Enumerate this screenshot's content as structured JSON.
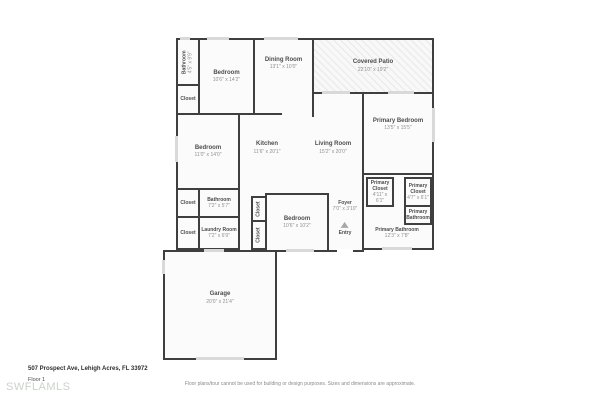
{
  "plan": {
    "address": "507 Prospect Ave, Lehigh Acres, FL 33972",
    "floor_label": "Floor 1",
    "watermark": "SWFLAMLS",
    "disclaimer": "Floor plans/tour cannot be used for building or design purposes. Sizes and dimensions are approximate.",
    "entry_label": "Entry",
    "colors": {
      "wall": "#3f3f3f",
      "room_fill": "#fbfbfb",
      "window": "#d9d9d9",
      "room_name_text": "#4d4d4d",
      "room_dim_text": "#909090",
      "watermark_text": "#ccd1cc"
    },
    "rooms": {
      "bathroom_top": {
        "name": "Bathroom",
        "dims": "4'5\" x 9'9\""
      },
      "closet_top": {
        "name": "Closet"
      },
      "bedroom_topleft": {
        "name": "Bedroom",
        "dims": "10'6\" x 14'2\""
      },
      "dining": {
        "name": "Dining Room",
        "dims": "13'1\" x 10'0\""
      },
      "patio": {
        "name": "Covered Patio",
        "dims": "22'10\" x 19'2\""
      },
      "primary_bedroom": {
        "name": "Primary Bedroom",
        "dims": "13'5\" x 15'5\""
      },
      "kitchen": {
        "name": "Kitchen",
        "dims": "11'6\" x 20'1\""
      },
      "living": {
        "name": "Living Room",
        "dims": "15'2\" x 20'0\""
      },
      "bedroom_left": {
        "name": "Bedroom",
        "dims": "11'0\" x 14'0\""
      },
      "closet_mid1": {
        "name": "Closet"
      },
      "bathroom_mid": {
        "name": "Bathroom",
        "dims": "7'2\" x 5'7\""
      },
      "closet_mid2": {
        "name": "Closet"
      },
      "laundry": {
        "name": "Laundry Room",
        "dims": "7'2\" x 6'9\""
      },
      "closet_v1": {
        "name": "Closet"
      },
      "closet_v2": {
        "name": "Closet"
      },
      "bedroom_bottom": {
        "name": "Bedroom",
        "dims": "10'6\" x 10'2\""
      },
      "foyer": {
        "name": "Foyer",
        "dims": "7'0\" x 3'10\""
      },
      "primary_closet_1": {
        "name": "Primary Closet",
        "dims": "4'11\" x 6'1\""
      },
      "primary_closet_2": {
        "name": "Primary Closet",
        "dims": "4'7\" x 6'1\""
      },
      "primary_bath_small": {
        "name": "Primary Bathroom"
      },
      "primary_bath": {
        "name": "Primary Bathroom",
        "dims": "12'3\" x 7'8\""
      },
      "garage": {
        "name": "Garage",
        "dims": "20'0\" x 21'4\""
      }
    }
  }
}
